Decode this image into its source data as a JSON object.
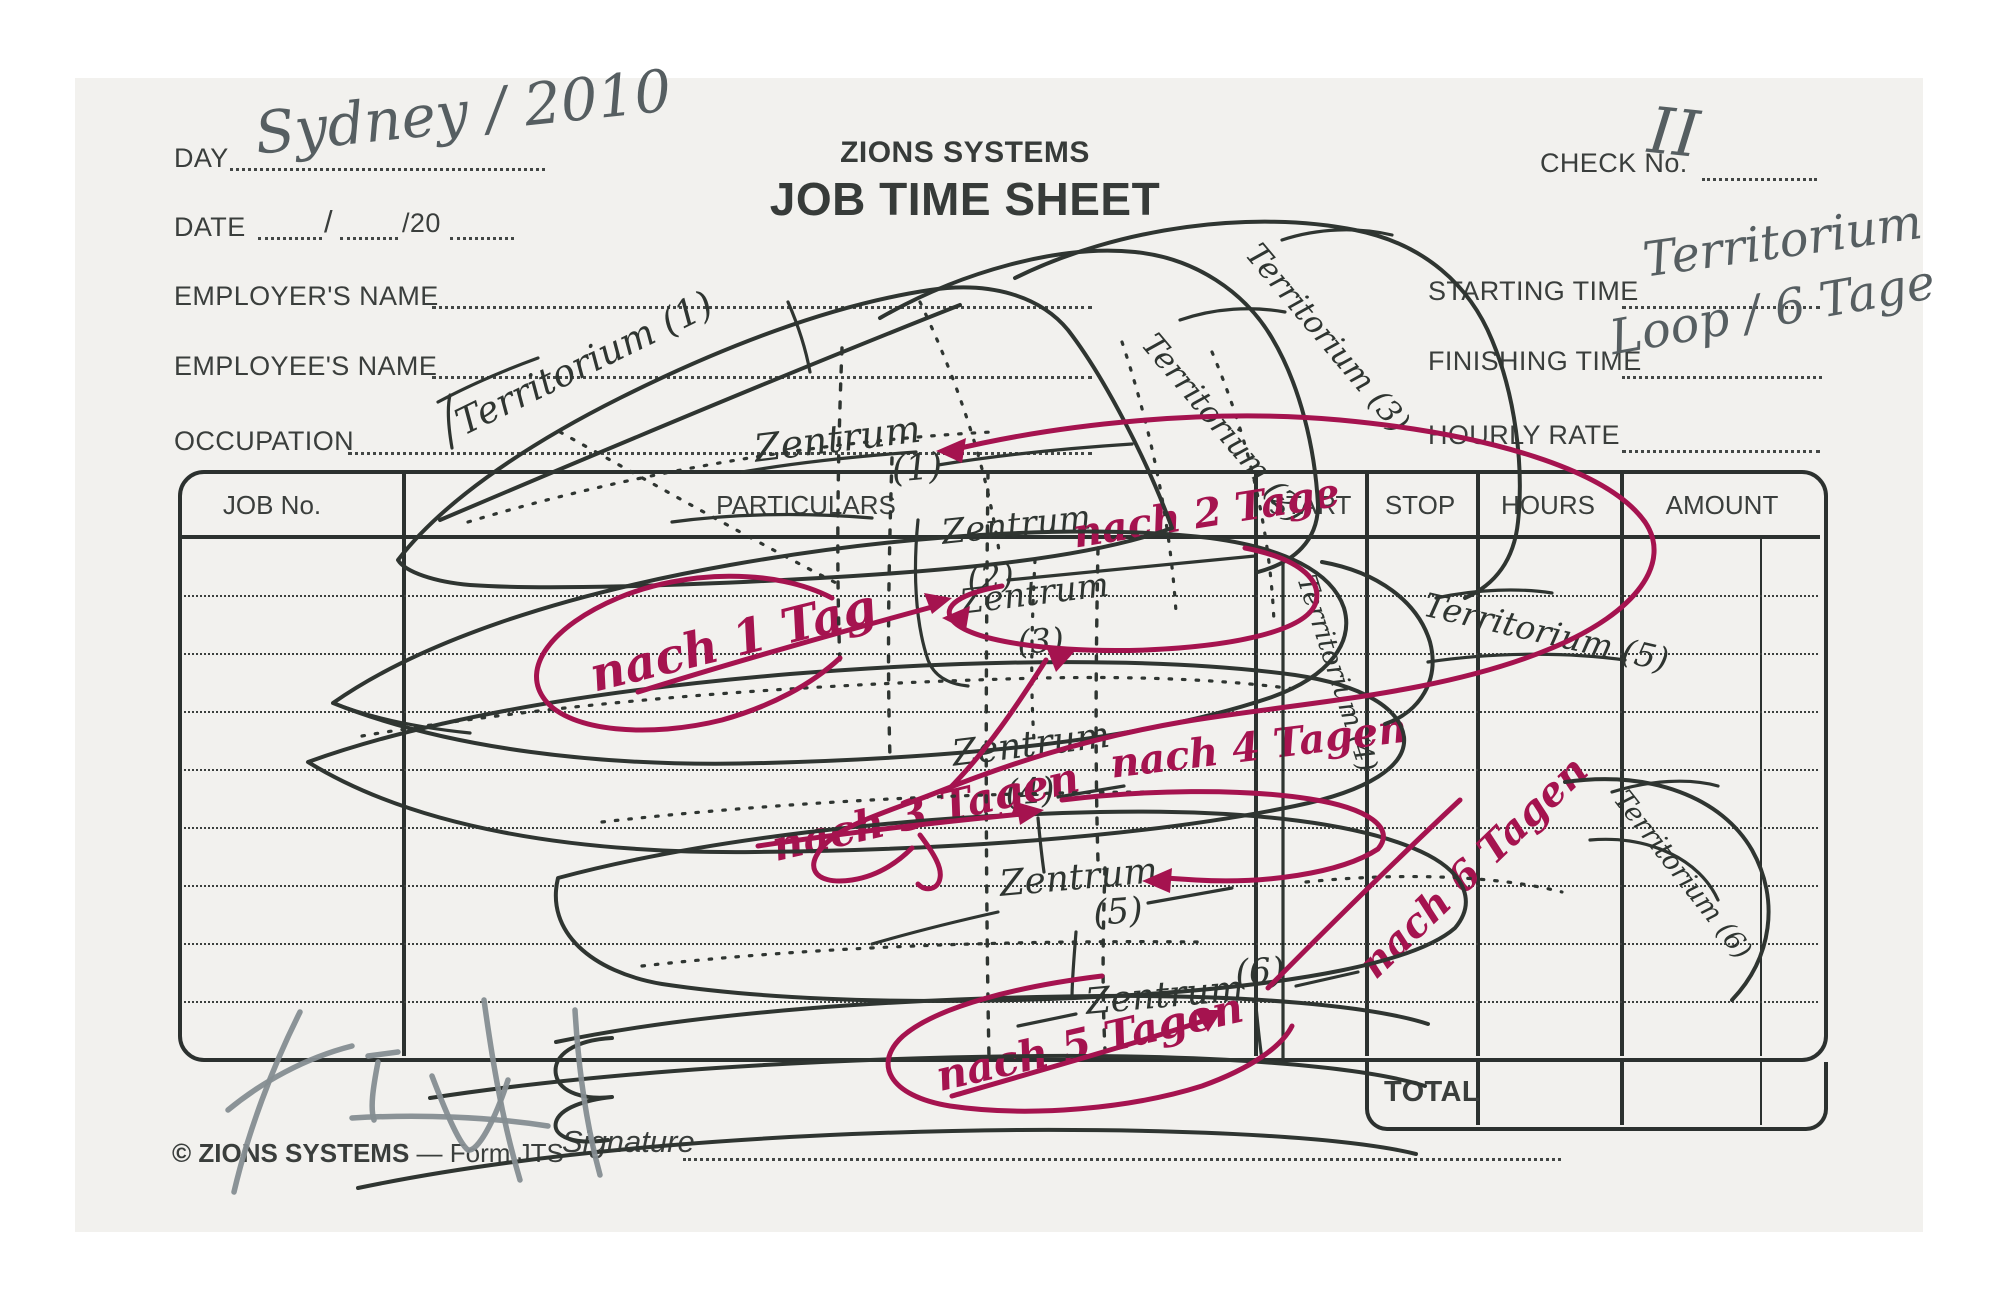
{
  "form": {
    "brand": "ZIONS SYSTEMS",
    "title": "JOB TIME SHEET",
    "fields": {
      "day_label": "DAY",
      "date_label": "DATE",
      "date_separator": "/",
      "date_year_prefix": "/20",
      "employer_label": "EMPLOYER'S NAME",
      "employee_label": "EMPLOYEE'S NAME",
      "occupation_label": "OCCUPATION",
      "check_no_label": "CHECK No.",
      "starting_time_label": "STARTING TIME",
      "finishing_time_label": "FINISHING TIME",
      "hourly_rate_label": "HOURLY RATE",
      "signature_label": "Signature"
    },
    "table": {
      "columns": [
        "JOB No.",
        "PARTICULARS",
        "START",
        "STOP",
        "HOURS",
        "AMOUNT"
      ],
      "row_count": 9,
      "total_label": "TOTAL"
    },
    "footer": {
      "copyright": "© ZIONS SYSTEMS",
      "form_ref": " — Form JTS"
    }
  },
  "handwriting": {
    "ink_color": "#2f3531",
    "red_color": "#a5134f",
    "pencil_color": "#858d91",
    "day_value": "Sydney / 2010",
    "check_no_value": "II",
    "starting_time_value": "Territorium",
    "finishing_time_value": "Loop / 6 Tage",
    "annotations": [
      {
        "id": "day-value",
        "text": "Sydney / 2010",
        "x": 252,
        "y": 104,
        "rot": -6,
        "size": 58,
        "ink": "gray"
      },
      {
        "id": "check-no-value",
        "text": "II",
        "x": 1652,
        "y": 98,
        "rot": 6,
        "size": 64,
        "ink": "gray"
      },
      {
        "id": "starting-time-value",
        "text": "Territorium",
        "x": 1640,
        "y": 236,
        "rot": -8,
        "size": 48,
        "ink": "gray"
      },
      {
        "id": "finishing-time-value",
        "text": "Loop / 6 Tage",
        "x": 1606,
        "y": 314,
        "rot": -10,
        "size": 48,
        "ink": "gray"
      },
      {
        "id": "territorium-1",
        "text": "Territorium (1)",
        "x": 450,
        "y": 408,
        "rot": -26,
        "size": 37,
        "ink": "black"
      },
      {
        "id": "territorium-2",
        "text": "Territorium (2)",
        "x": 1160,
        "y": 328,
        "rot": 50,
        "size": 31,
        "ink": "black"
      },
      {
        "id": "territorium-3",
        "text": "Territorium (3)",
        "x": 1264,
        "y": 238,
        "rot": 50,
        "size": 31,
        "ink": "black"
      },
      {
        "id": "territorium-4",
        "text": "Territorium (4)",
        "x": 1318,
        "y": 572,
        "rot": 72,
        "size": 27,
        "ink": "black"
      },
      {
        "id": "territorium-5",
        "text": "Territorium (5)",
        "x": 1428,
        "y": 588,
        "rot": 13,
        "size": 33,
        "ink": "black"
      },
      {
        "id": "territorium-6",
        "text": "Territorium (6)",
        "x": 1630,
        "y": 786,
        "rot": 52,
        "size": 27,
        "ink": "black"
      },
      {
        "id": "zentrum-1",
        "text": "Zentrum",
        "x": 752,
        "y": 430,
        "rot": -7,
        "size": 38,
        "ink": "black"
      },
      {
        "id": "zentrum-1-num",
        "text": "(1)",
        "x": 890,
        "y": 452,
        "rot": -5,
        "size": 36,
        "ink": "black"
      },
      {
        "id": "zentrum-2",
        "text": "Zentrum",
        "x": 940,
        "y": 516,
        "rot": -6,
        "size": 34,
        "ink": "black"
      },
      {
        "id": "zentrum-2-num",
        "text": "(2)",
        "x": 966,
        "y": 562,
        "rot": -4,
        "size": 33,
        "ink": "black"
      },
      {
        "id": "zentrum-3",
        "text": "Zentrum",
        "x": 958,
        "y": 586,
        "rot": -7,
        "size": 34,
        "ink": "black"
      },
      {
        "id": "zentrum-3-num",
        "text": "(3)",
        "x": 1016,
        "y": 626,
        "rot": -4,
        "size": 33,
        "ink": "black"
      },
      {
        "id": "zentrum-4",
        "text": "Zentrum",
        "x": 950,
        "y": 736,
        "rot": -7,
        "size": 36,
        "ink": "black"
      },
      {
        "id": "zentrum-4-num",
        "text": "(4)",
        "x": 1004,
        "y": 776,
        "rot": -4,
        "size": 35,
        "ink": "black"
      },
      {
        "id": "zentrum-5",
        "text": "Zentrum",
        "x": 998,
        "y": 866,
        "rot": -5,
        "size": 36,
        "ink": "black"
      },
      {
        "id": "zentrum-5-num",
        "text": "(5)",
        "x": 1092,
        "y": 896,
        "rot": -4,
        "size": 35,
        "ink": "black"
      },
      {
        "id": "zentrum-6",
        "text": "Zentrum",
        "x": 1084,
        "y": 984,
        "rot": -5,
        "size": 36,
        "ink": "black"
      },
      {
        "id": "zentrum-6-num",
        "text": "(6)",
        "x": 1234,
        "y": 956,
        "rot": -4,
        "size": 35,
        "ink": "black"
      },
      {
        "id": "nach-1-tag",
        "text": "nach 1 Tag",
        "x": 585,
        "y": 652,
        "rot": -14,
        "size": 48,
        "ink": "red"
      },
      {
        "id": "nach-2-tage",
        "text": "nach 2 Tage",
        "x": 1070,
        "y": 514,
        "rot": -9,
        "size": 40,
        "ink": "red"
      },
      {
        "id": "nach-3-tagen",
        "text": "nach 3 Tagen",
        "x": 768,
        "y": 826,
        "rot": -13,
        "size": 42,
        "ink": "red"
      },
      {
        "id": "nach-4-tagen",
        "text": "nach 4 Tagen",
        "x": 1108,
        "y": 744,
        "rot": -7,
        "size": 40,
        "ink": "red"
      },
      {
        "id": "nach-5-tagen",
        "text": "nach 5 Tagen",
        "x": 932,
        "y": 1056,
        "rot": -13,
        "size": 42,
        "ink": "red"
      },
      {
        "id": "nach-6-tagen",
        "text": "nach 6 Tagen",
        "x": 1352,
        "y": 956,
        "rot": -44,
        "size": 40,
        "ink": "red"
      }
    ]
  }
}
